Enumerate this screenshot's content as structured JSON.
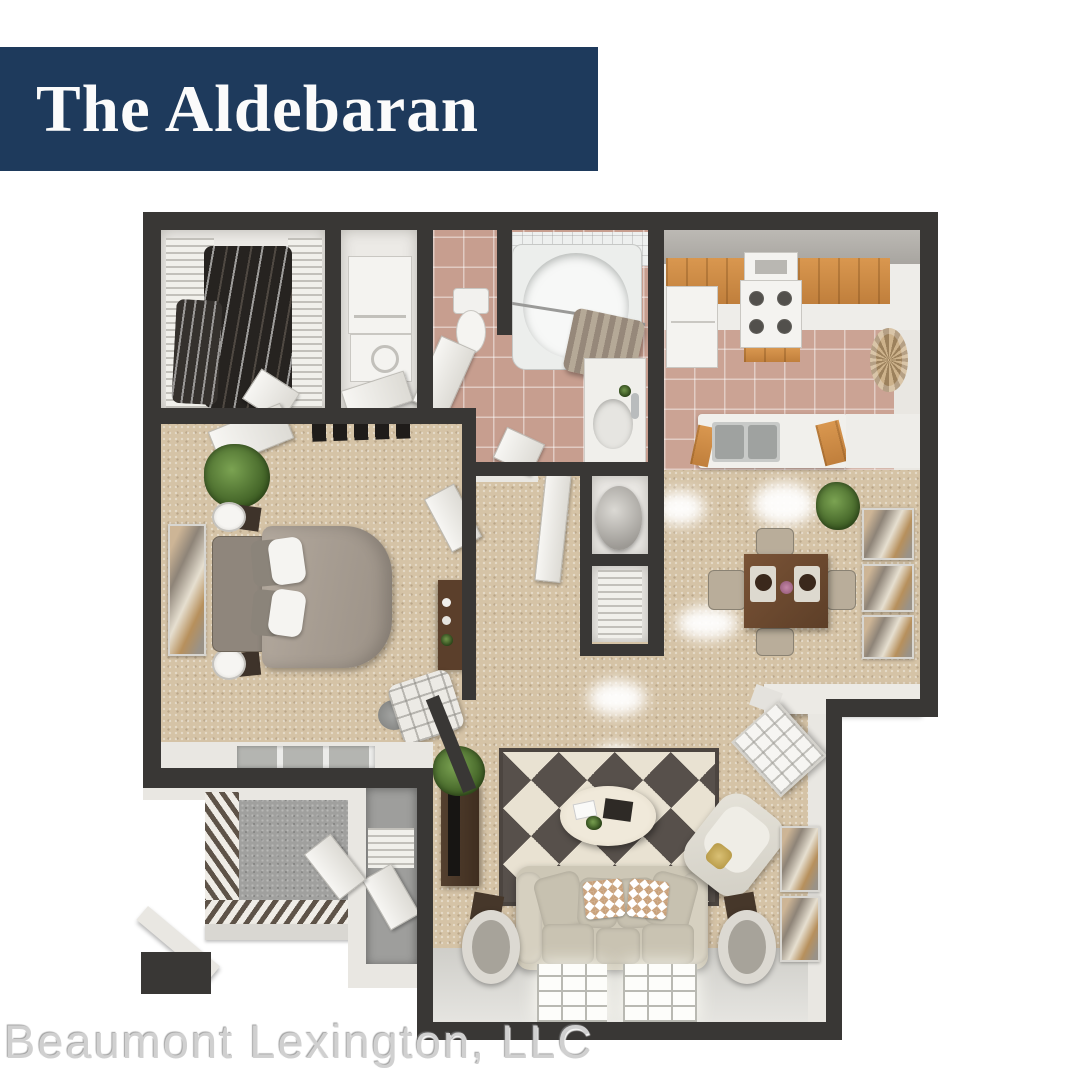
{
  "banner": {
    "title": "The Aldebaran",
    "bg_color": "#1e3a5c",
    "text_color": "#fbfbfb"
  },
  "watermark": {
    "text": "Beaumont Lexington, LLC",
    "color": "#d0d0d0"
  },
  "palette": {
    "wall_dark": "#393735",
    "carpet": "#d5c3a6",
    "tile": "#c79e8f",
    "interior_white": "#eceae6",
    "wood_cabinet": "#d9974f",
    "concrete": "#a0a09e",
    "rug_dark": "#57504b",
    "rug_light": "#e9e2d2",
    "sofa": "#cdc7b6",
    "bed": "#a79d92",
    "dining_table": "#6e4a31"
  },
  "floor_plan": {
    "type": "3d-rendered-top-down-apartment",
    "unit_name": "The Aldebaran",
    "rooms": [
      {
        "name": "walk-in-closet",
        "features": [
          "wire-shelving",
          "hanging-clothes"
        ]
      },
      {
        "name": "laundry-closet",
        "features": [
          "stacked-washer-dryer"
        ]
      },
      {
        "name": "toilet-room",
        "features": [
          "toilet"
        ]
      },
      {
        "name": "bathroom",
        "features": [
          "bathtub",
          "shower-curtain",
          "vanity-sink"
        ]
      },
      {
        "name": "kitchen",
        "features": [
          "refrigerator",
          "stove",
          "range-hood",
          "wood-cabinets",
          "double-sink",
          "wicker-decor"
        ]
      },
      {
        "name": "bedroom",
        "features": [
          "bed",
          "nightstands",
          "lamps",
          "wall-art",
          "plant",
          "desk",
          "lounge-chair",
          "windows"
        ]
      },
      {
        "name": "hallway",
        "features": [
          "doors",
          "water-heater-closet",
          "linen-closet"
        ]
      },
      {
        "name": "dining-area",
        "features": [
          "dining-table",
          "four-chairs",
          "triptych-art",
          "plant"
        ]
      },
      {
        "name": "living-room",
        "features": [
          "geometric-rug",
          "oval-coffee-table",
          "sofa",
          "chevron-pillows",
          "accent-chair",
          "drum-lamps",
          "tv-console",
          "windows",
          "wall-art",
          "entry-door"
        ]
      },
      {
        "name": "patio",
        "features": [
          "railing",
          "concrete-floor",
          "storage-closet"
        ]
      }
    ]
  }
}
